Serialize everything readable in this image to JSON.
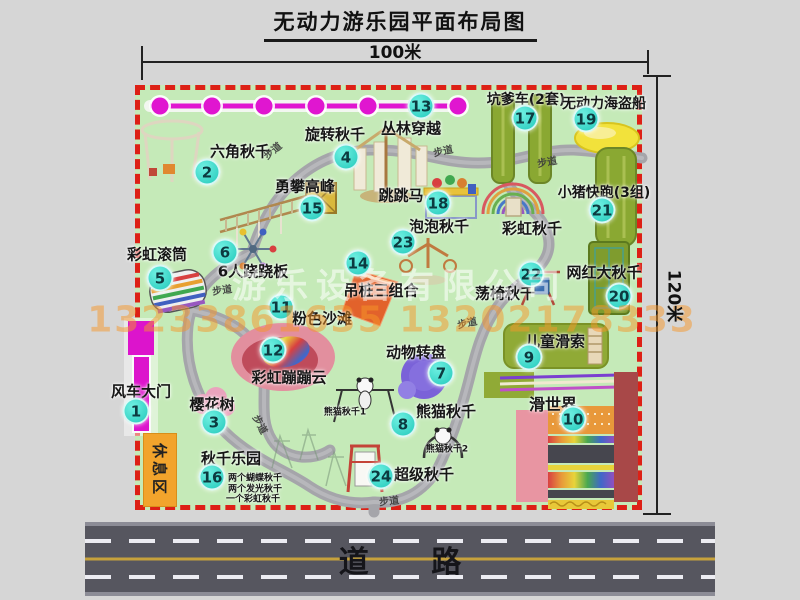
{
  "title": "无动力游乐园平面布局图",
  "dimensions": {
    "top": "100米",
    "right": "120米"
  },
  "road_label": "道 路",
  "rest_area_label": "休息区",
  "watermark": {
    "company": "游乐设备有限公司",
    "phone": "13233861635 13202178333"
  },
  "colors": {
    "map_bg": "#c5eab8",
    "border_red": "#dd2016",
    "badge_teal": "#23c9bb",
    "chain_magenta": "#e016d0",
    "road_gray": "#56565f",
    "path_gray": "#a5a5aa"
  },
  "items": [
    {
      "num": "1",
      "label": "风车大门",
      "label_x": 141,
      "label_y": 391,
      "badge_x": 136,
      "badge_y": 411,
      "size": 15
    },
    {
      "num": "2",
      "label": "六角秋千",
      "label_x": 240,
      "label_y": 151,
      "badge_x": 207,
      "badge_y": 172,
      "size": 15
    },
    {
      "num": "3",
      "label": "樱花树",
      "label_x": 212,
      "label_y": 404,
      "badge_x": 214,
      "badge_y": 422,
      "size": 15
    },
    {
      "num": "4",
      "label": "旋转秋千",
      "label_x": 335,
      "label_y": 134,
      "badge_x": 346,
      "badge_y": 157,
      "size": 15
    },
    {
      "num": "5",
      "label": "彩虹滚筒",
      "label_x": 157,
      "label_y": 254,
      "badge_x": 160,
      "badge_y": 278,
      "size": 15
    },
    {
      "num": "6",
      "label": "6人跷跷板",
      "label_x": 253,
      "label_y": 271,
      "badge_x": 225,
      "badge_y": 252,
      "size": 15
    },
    {
      "num": "7",
      "label": "动物转盘",
      "label_x": 416,
      "label_y": 352,
      "badge_x": 441,
      "badge_y": 373,
      "size": 15
    },
    {
      "num": "8",
      "label": "熊猫秋千",
      "label_x": 446,
      "label_y": 411,
      "badge_x": 403,
      "badge_y": 424,
      "size": 15
    },
    {
      "num": "9",
      "label": "儿童滑索",
      "label_x": 555,
      "label_y": 341,
      "badge_x": 529,
      "badge_y": 357,
      "size": 15
    },
    {
      "num": "10",
      "label": "滑世界",
      "label_x": 553,
      "label_y": 403,
      "badge_x": 573,
      "badge_y": 419,
      "size": 16
    },
    {
      "num": "11",
      "label": "粉色沙滩",
      "label_x": 322,
      "label_y": 318,
      "badge_x": 281,
      "badge_y": 307,
      "size": 15
    },
    {
      "num": "12",
      "label": "彩虹蹦蹦云",
      "label_x": 289,
      "label_y": 377,
      "badge_x": 273,
      "badge_y": 350,
      "size": 15
    },
    {
      "num": "13",
      "label": "丛林穿越",
      "label_x": 411,
      "label_y": 128,
      "badge_x": 421,
      "badge_y": 106,
      "size": 15
    },
    {
      "num": "14",
      "label": "吊桩三组合",
      "label_x": 381,
      "label_y": 290,
      "badge_x": 358,
      "badge_y": 263,
      "size": 15
    },
    {
      "num": "15",
      "label": "勇攀高峰",
      "label_x": 305,
      "label_y": 186,
      "badge_x": 312,
      "badge_y": 208,
      "size": 15
    },
    {
      "num": "16",
      "label": "秋千乐园",
      "label_x": 231,
      "label_y": 458,
      "badge_x": 212,
      "badge_y": 477,
      "size": 15
    },
    {
      "num": "17",
      "label": "坑爹车(2套)",
      "label_x": 526,
      "label_y": 99,
      "badge_x": 525,
      "badge_y": 118,
      "size": 14
    },
    {
      "num": "18",
      "label": "跳跳马",
      "label_x": 401,
      "label_y": 195,
      "badge_x": 438,
      "badge_y": 203,
      "size": 15
    },
    {
      "num": "19",
      "label": "无动力海盗船",
      "label_x": 604,
      "label_y": 103,
      "badge_x": 586,
      "badge_y": 119,
      "size": 14
    },
    {
      "num": "20",
      "label": "网红大秋千",
      "label_x": 604,
      "label_y": 272,
      "badge_x": 619,
      "badge_y": 296,
      "size": 15
    },
    {
      "num": "21",
      "label": "小猪快跑(3组)",
      "label_x": 604,
      "label_y": 192,
      "badge_x": 602,
      "badge_y": 210,
      "size": 14
    },
    {
      "num": "22",
      "label": "荡椅秋千",
      "label_x": 505,
      "label_y": 293,
      "badge_x": 531,
      "badge_y": 274,
      "size": 15
    },
    {
      "num": "23",
      "label": "泡泡秋千",
      "label_x": 439,
      "label_y": 226,
      "badge_x": 403,
      "badge_y": 242,
      "size": 15
    },
    {
      "num": "24",
      "label": "超级秋千",
      "label_x": 424,
      "label_y": 474,
      "badge_x": 381,
      "badge_y": 476,
      "size": 15
    }
  ],
  "extra_labels": [
    {
      "text": "彩虹秋千",
      "x": 532,
      "y": 228,
      "size": 15,
      "rot": 0
    },
    {
      "text": "熊猫秋千1",
      "x": 345,
      "y": 411,
      "size": 9,
      "rot": 0
    },
    {
      "text": "熊猫秋千2",
      "x": 447,
      "y": 448,
      "size": 9,
      "rot": 0
    },
    {
      "text": "两个蝴蝶秋千",
      "x": 255,
      "y": 477,
      "size": 9,
      "rot": 0
    },
    {
      "text": "两个发光秋千",
      "x": 255,
      "y": 488,
      "size": 9,
      "rot": 0
    },
    {
      "text": "一个彩虹秋千",
      "x": 253,
      "y": 498,
      "size": 9,
      "rot": 0
    }
  ],
  "path_labels": [
    {
      "text": "步道",
      "x": 272,
      "y": 150,
      "rot": -40
    },
    {
      "text": "步道",
      "x": 443,
      "y": 150,
      "rot": -12
    },
    {
      "text": "步道",
      "x": 547,
      "y": 161,
      "rot": -10
    },
    {
      "text": "步道",
      "x": 222,
      "y": 289,
      "rot": -8
    },
    {
      "text": "步道",
      "x": 467,
      "y": 322,
      "rot": -12
    },
    {
      "text": "步道",
      "x": 261,
      "y": 424,
      "rot": 62
    },
    {
      "text": "步道",
      "x": 389,
      "y": 500,
      "rot": -6
    }
  ]
}
